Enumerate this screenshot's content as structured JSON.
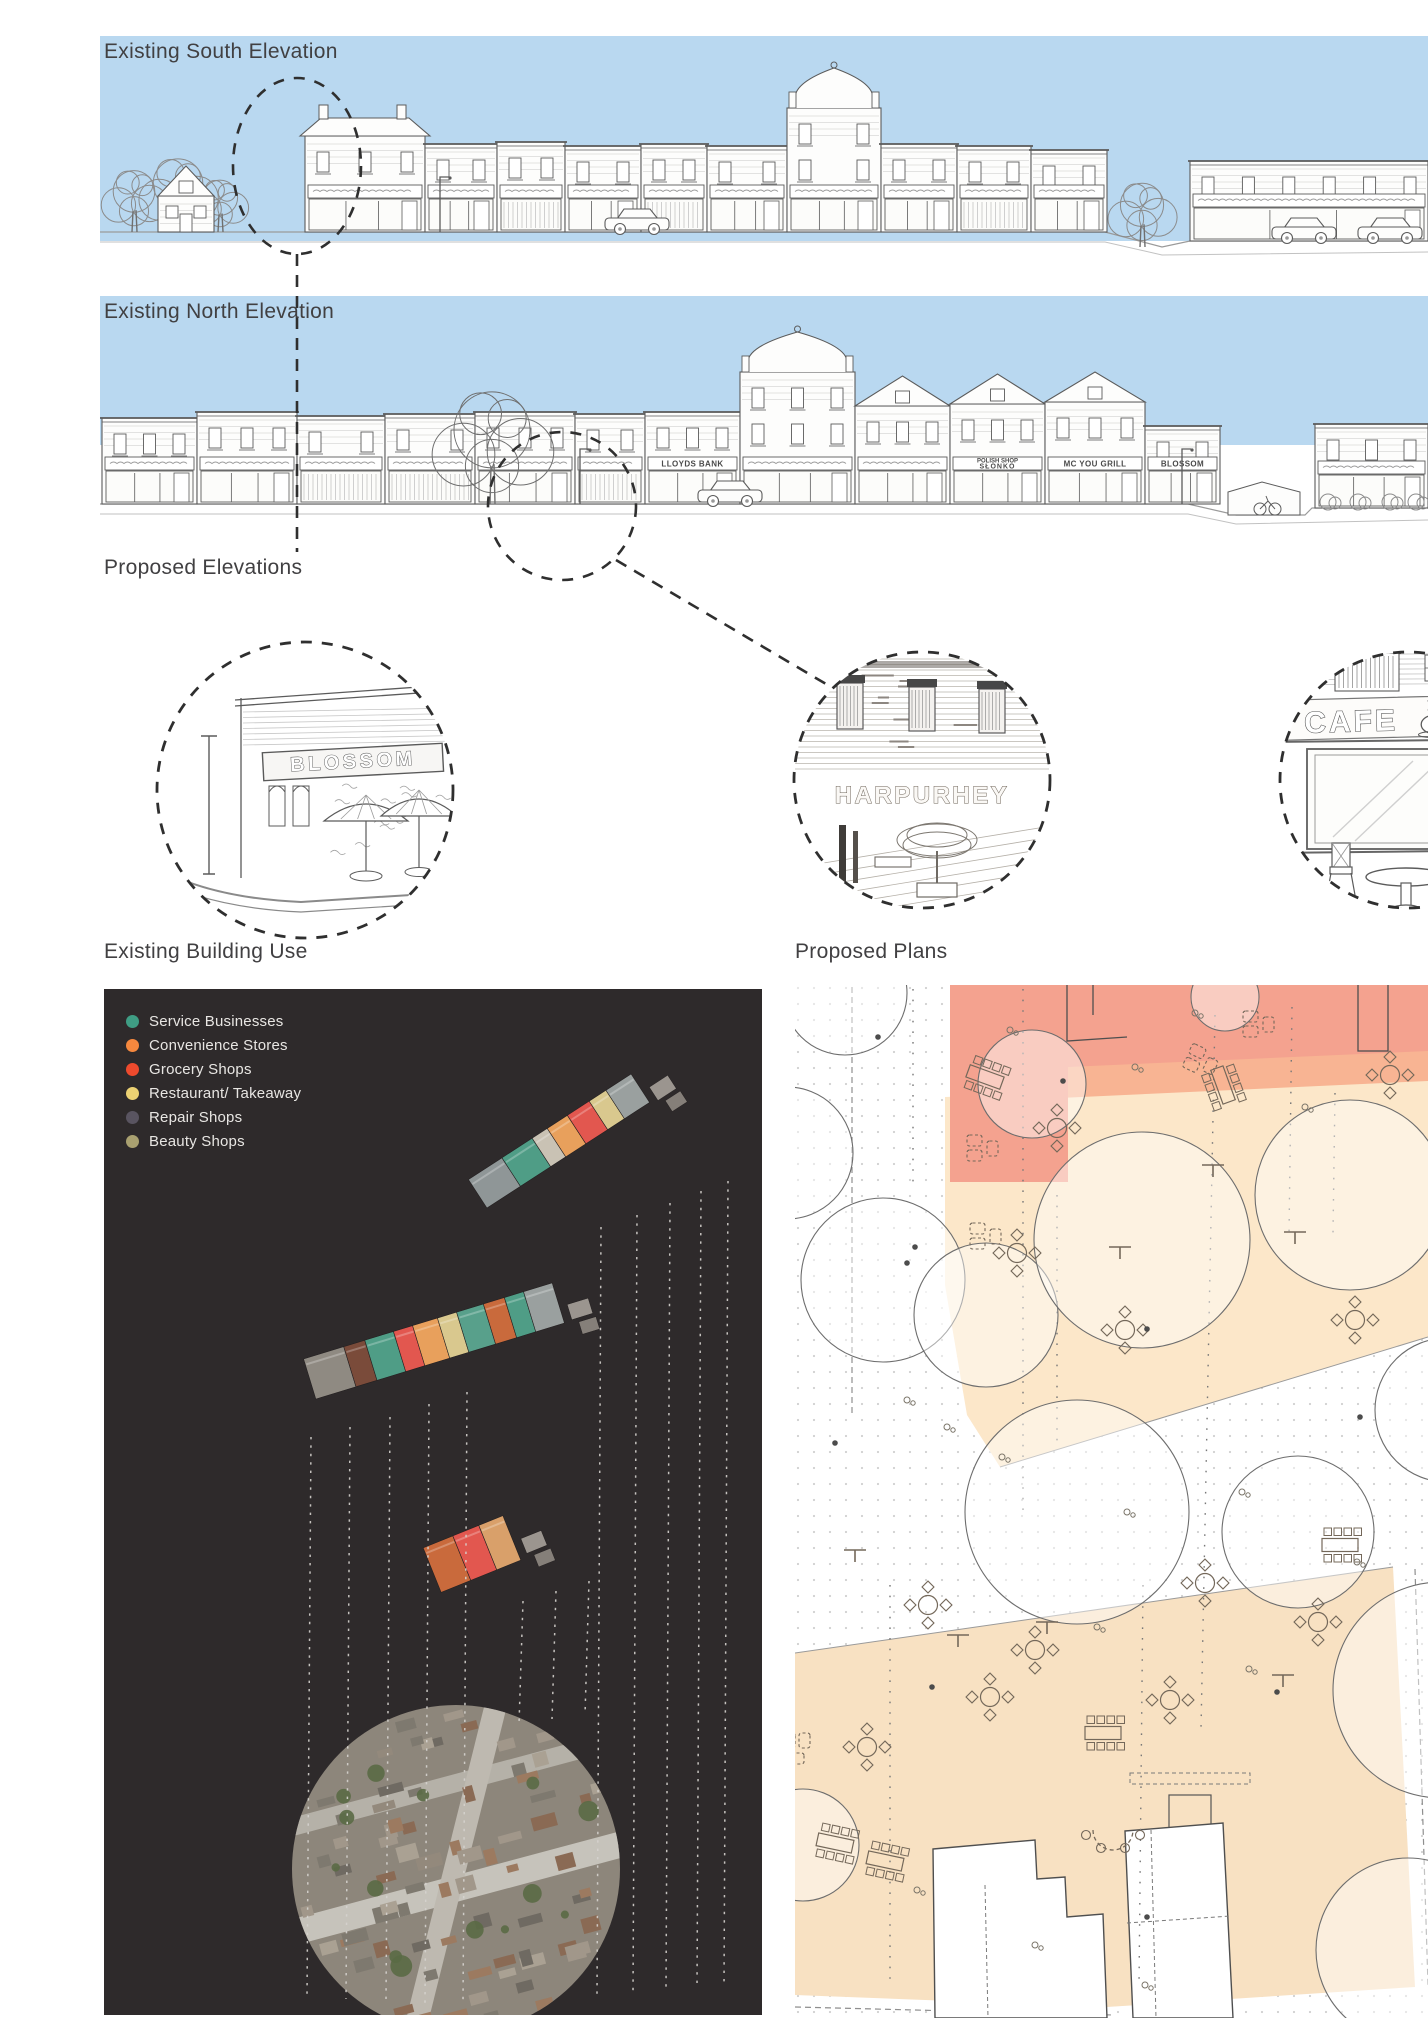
{
  "palette": {
    "sky": "#b9d8f0",
    "ink": "#5b5b5b",
    "title_text": "#414042",
    "panel_bg": "#2e2a2b",
    "legend_text": "#e8e6e3",
    "dashed_line": "#2f2f2f",
    "plan_salmon": "#f4a28f",
    "plan_salmon_band": "#f8b493",
    "plan_cream": "#fce7c9",
    "plan_peach": "#f8e1c2",
    "plan_tree_stroke": "#6d6d6d",
    "plan_furniture": "#74685a",
    "plan_dots": "#a9a9a9"
  },
  "south_elevation": {
    "title": "Existing South Elevation"
  },
  "north_elevation": {
    "title": "Existing North Elevation",
    "signs": {
      "lloyds_bank": "LLOYDS BANK",
      "polish_shop_line1": "POLISH SHOP",
      "polish_shop_line2": "SŁONKO",
      "grill": "MC YOU GRILL",
      "blossom": "BLOSSOM"
    }
  },
  "proposed_elevations": {
    "title": "Proposed Elevations",
    "details": [
      {
        "id": "blossom-corner-cafe",
        "sign_text": "BLOSSOM"
      },
      {
        "id": "harpurhey-mural-garden",
        "sign_text": "HARPURHEY"
      },
      {
        "id": "cafe-shopfront",
        "sign_text": "CAFE"
      }
    ]
  },
  "existing_building_use": {
    "title": "Existing Building Use",
    "legend": [
      {
        "label": "Service Businesses",
        "color": "#3f9d84"
      },
      {
        "label": "Convenience Stores",
        "color": "#f6883e"
      },
      {
        "label": "Grocery Shops",
        "color": "#ee4a2d"
      },
      {
        "label": "Restaurant/ Takeaway",
        "color": "#ecd173"
      },
      {
        "label": "Repair Shops",
        "color": "#595460"
      },
      {
        "label": "Beauty Shops",
        "color": "#a9a070"
      }
    ]
  },
  "proposed_plans": {
    "title": "Proposed Plans",
    "zones": [
      {
        "name": "plaza-salmon-zone",
        "color": "#f4a28f"
      },
      {
        "name": "terrace-salmon-band",
        "color": "#f8b493"
      },
      {
        "name": "outdoor-dining-cream-zone",
        "color": "#fce7c9"
      },
      {
        "name": "market-square-peach-zone",
        "color": "#f8e1c2"
      }
    ]
  }
}
